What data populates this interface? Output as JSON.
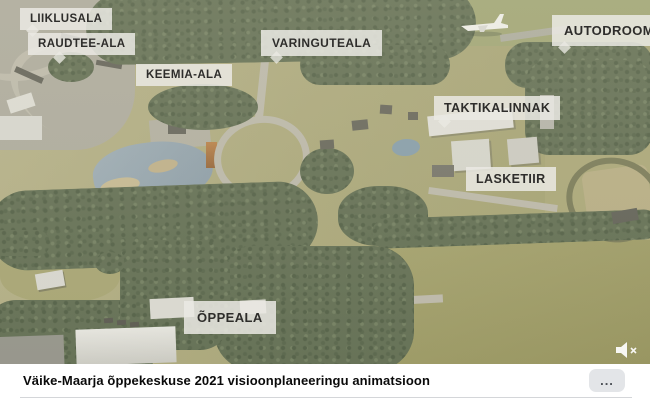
{
  "colors": {
    "label_bg": "#eae9e3",
    "label_text": "#2e2d2b",
    "footer_bg": "#ffffff",
    "footer_title_color": "#0a0a0a",
    "more_button_bg": "#e3e5e8",
    "forest_green": "#57654a",
    "field_olive": "#a6a375",
    "lake_blue": "#8da0ae"
  },
  "video": {
    "map_labels": [
      {
        "text": "LIIKLUSALA"
      },
      {
        "text": "RAUDTEE-ALA"
      },
      {
        "text": "KEEMIA-ALA"
      },
      {
        "text": "VARINGUTEALA"
      },
      {
        "text": "AUTODROOM"
      },
      {
        "text": "TAKTIKALINNAK"
      },
      {
        "text": "LASKETIIR"
      },
      {
        "text": "ÕPPEALA"
      }
    ],
    "icons": {
      "mute": "speaker-muted-icon"
    }
  },
  "footer": {
    "title": "Väike-Maarja õppekeskuse 2021 visioonplaneeringu animatsioon",
    "more_button_label": "..."
  }
}
